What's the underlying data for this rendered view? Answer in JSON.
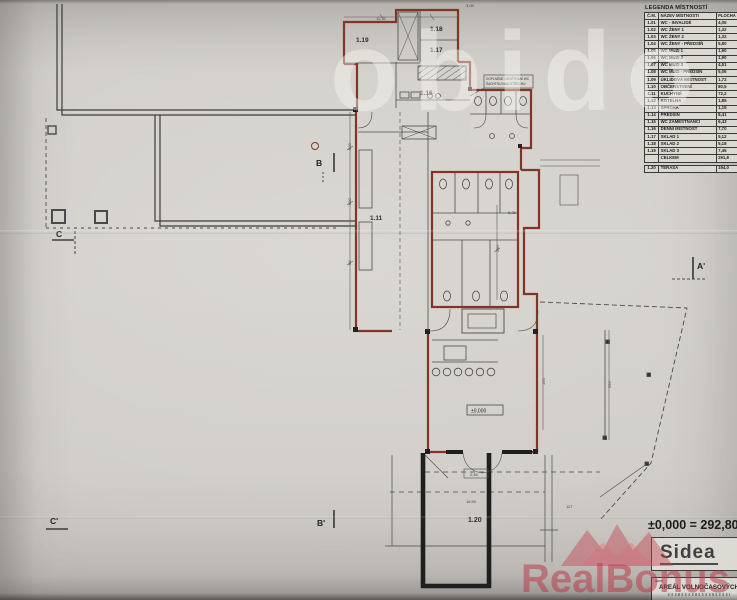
{
  "legend": {
    "title": "LEGENDA MÍSTNOSTÍ",
    "col_num": "Č.M.",
    "col_name": "NÁZEV MÍSTNOSTI",
    "col_area": "PLOCHA (m²)",
    "rows": [
      {
        "num": "1.01",
        "name": "WC - INVALIDÉ",
        "area": "4,05"
      },
      {
        "num": "1.02",
        "name": "WC ŽENY 1",
        "area": "1,32"
      },
      {
        "num": "1.03",
        "name": "WC ŽENY 2",
        "area": "1,32"
      },
      {
        "num": "1.04",
        "name": "WC ŽENY - PŘEDSÍŇ",
        "area": "5,80"
      },
      {
        "num": "1.05",
        "name": "WC MUŽI 1",
        "area": "1,90"
      },
      {
        "num": "1.06",
        "name": "WC MUŽI 2",
        "area": "1,90"
      },
      {
        "num": "1.07",
        "name": "WC MUŽI 3",
        "area": "4,51"
      },
      {
        "num": "1.08",
        "name": "WC MUŽI - PŘEDSÍŇ",
        "area": "5,06"
      },
      {
        "num": "1.09",
        "name": "ÚKLIDOVÁ MÍSTNOST",
        "area": "1,72"
      },
      {
        "num": "1.10",
        "name": "OBČERSTVENÍ",
        "area": "80,5"
      },
      {
        "num": "1.11",
        "name": "KUCHYNĚ",
        "area": "72,2"
      },
      {
        "num": "1.12",
        "name": "KOTELNA",
        "area": "1,85"
      },
      {
        "num": "1.13",
        "name": "SPRCHA",
        "area": "1,15"
      },
      {
        "num": "1.14",
        "name": "PŘEDSÍŇ",
        "area": "8,41"
      },
      {
        "num": "1.15",
        "name": "WC ZAMĚSTNANCI",
        "area": "6,43"
      },
      {
        "num": "1.16",
        "name": "DENNÍ MÍSTNOST",
        "area": "7,70"
      },
      {
        "num": "1.17",
        "name": "SKLAD 1",
        "area": "5,12"
      },
      {
        "num": "1.18",
        "name": "SKLAD 2",
        "area": "5,18"
      },
      {
        "num": "1.19",
        "name": "SKLAD 3",
        "area": "7,45"
      }
    ],
    "total_label": "CELKEM",
    "total_area": "291,8",
    "terrace": {
      "num": "1.20",
      "name": "TERASA",
      "area": "194,0"
    }
  },
  "titleblock": {
    "elevation": "±0,000 = 292,800",
    "logo": "Sidea",
    "akce_label": "Akce:",
    "project": "AREÁL VOLNOČASOVÝCH"
  },
  "watermarks": {
    "top": "obido",
    "bottom": "RealBonus"
  },
  "plan": {
    "room_labels": [
      {
        "t": "1.19"
      },
      {
        "t": "1.18"
      },
      {
        "t": "1.17"
      },
      {
        "t": "1.16"
      },
      {
        "t": "1.11"
      },
      {
        "t": "1.20"
      }
    ],
    "sections": [
      {
        "t": "B"
      },
      {
        "t": "C"
      },
      {
        "t": "A'"
      },
      {
        "t": "B'"
      },
      {
        "t": "C'"
      }
    ],
    "level_marker": "±0,000",
    "note_line1": "DOPLNĚNÉ ODVĚTRÁNÍ WC",
    "note_line2": "ŠACHTOU NAD STŘECHU",
    "dims": [
      {
        "t": "11,72"
      },
      {
        "t": "3,05"
      },
      {
        "t": "6,25"
      },
      {
        "t": "2,45"
      },
      {
        "t": "16,90"
      },
      {
        "t": "117"
      },
      {
        "t": "500"
      },
      {
        "t": "600"
      },
      {
        "t": "90"
      },
      {
        "t": "250"
      },
      {
        "t": "150"
      },
      {
        "t": "595"
      }
    ]
  },
  "colors": {
    "wall_red": "#823527",
    "line_black": "#2f2f2f",
    "paper": "#d0cdc8",
    "watermark_red": "#c23d50"
  }
}
